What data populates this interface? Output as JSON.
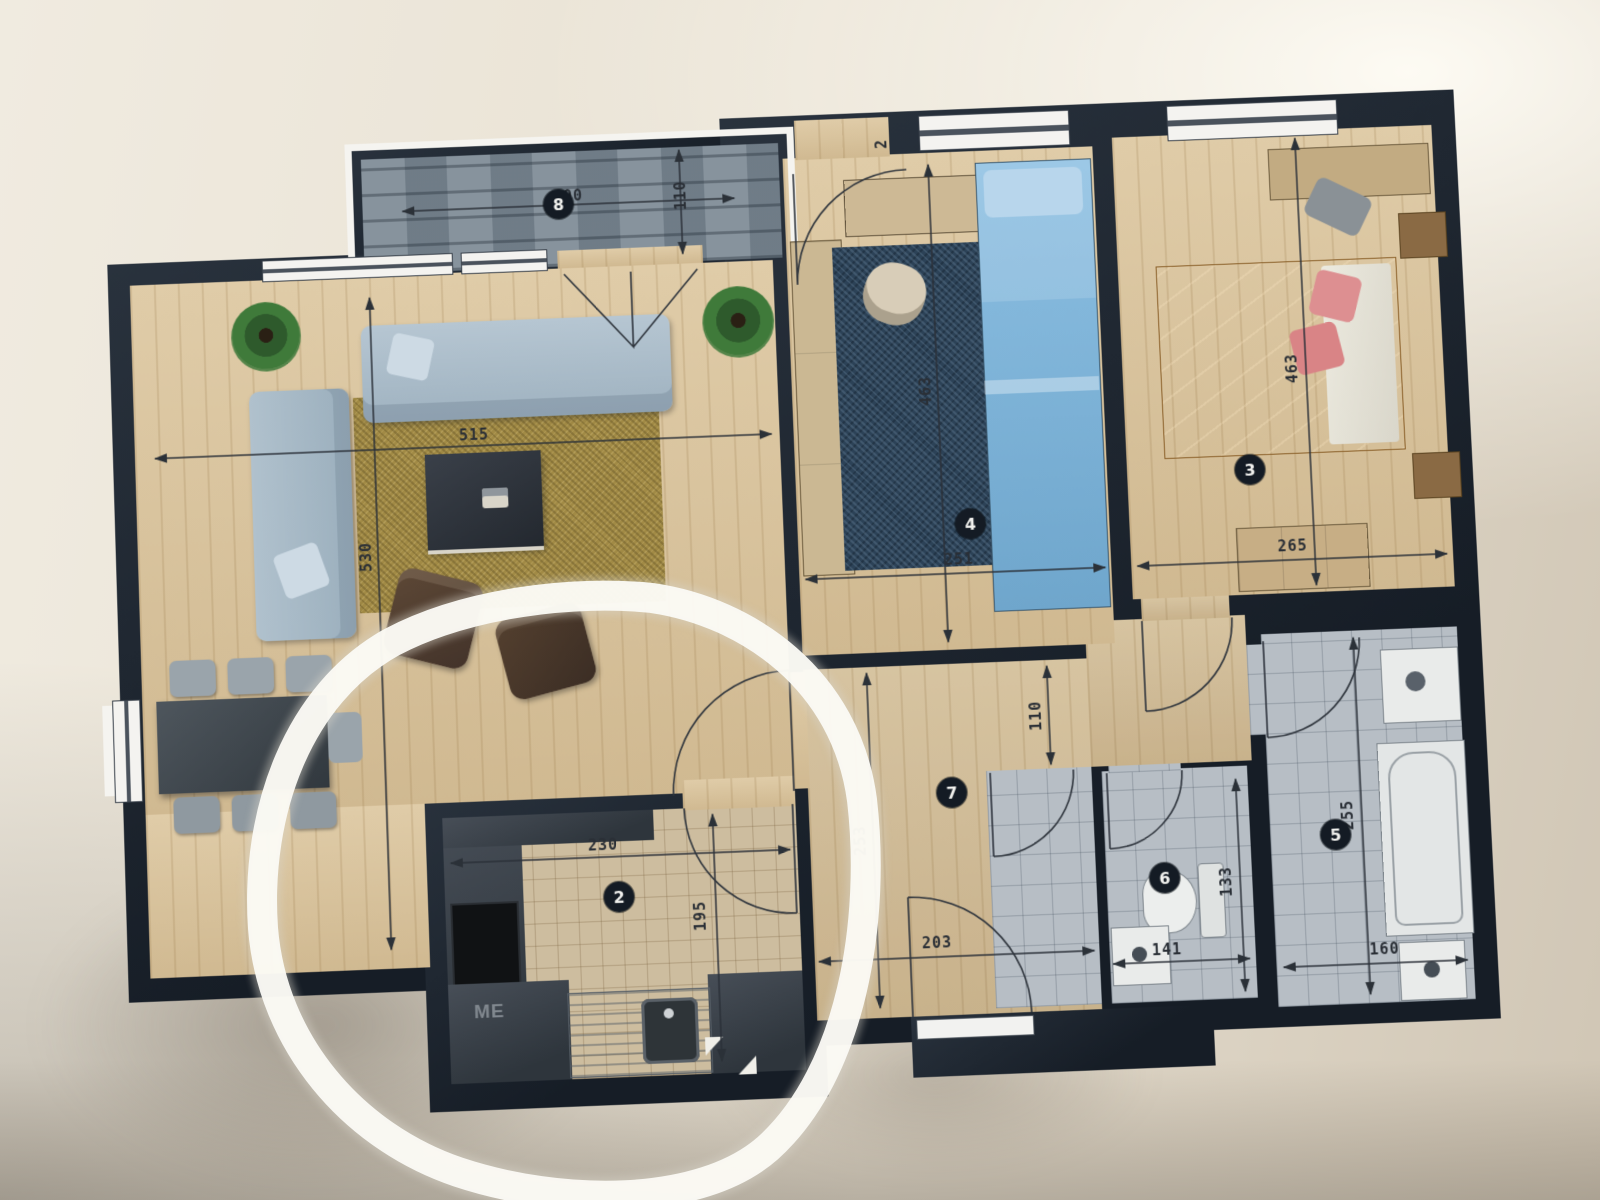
{
  "plan": {
    "marker_color": "#fbfaf5",
    "colors": {
      "walls": "#1a222c",
      "wood_floor": "#dcc69e",
      "balcony_stone": "#7e8b96",
      "bed_single_blue": "#7fb5d9",
      "bed_double_orange": "#e8a254",
      "rug_gold": "#a18a45",
      "rug_navy": "#2c4257"
    },
    "badges": {
      "balcony": "8",
      "kitchen": "2",
      "bedroom_right": "3",
      "bedroom_middle": "4",
      "bathroom": "5",
      "wc": "6",
      "hall": "7"
    },
    "labels": {
      "kitchen_cabinet": "ME"
    },
    "dims": {
      "balcony_w": "400",
      "balcony_d": "110",
      "living_w": "515",
      "living_d": "530",
      "entry": "2",
      "bed4_d": "463",
      "bed4_w": "251",
      "bed3_d": "463",
      "bed3_w": "265",
      "hall_n": "110",
      "hall_s": "253",
      "hall_w": "203",
      "kitchen_w": "230",
      "kitchen_d": "195",
      "wc_w": "141",
      "wc_d": "133",
      "bath_d": "255",
      "bath_w": "160"
    }
  }
}
